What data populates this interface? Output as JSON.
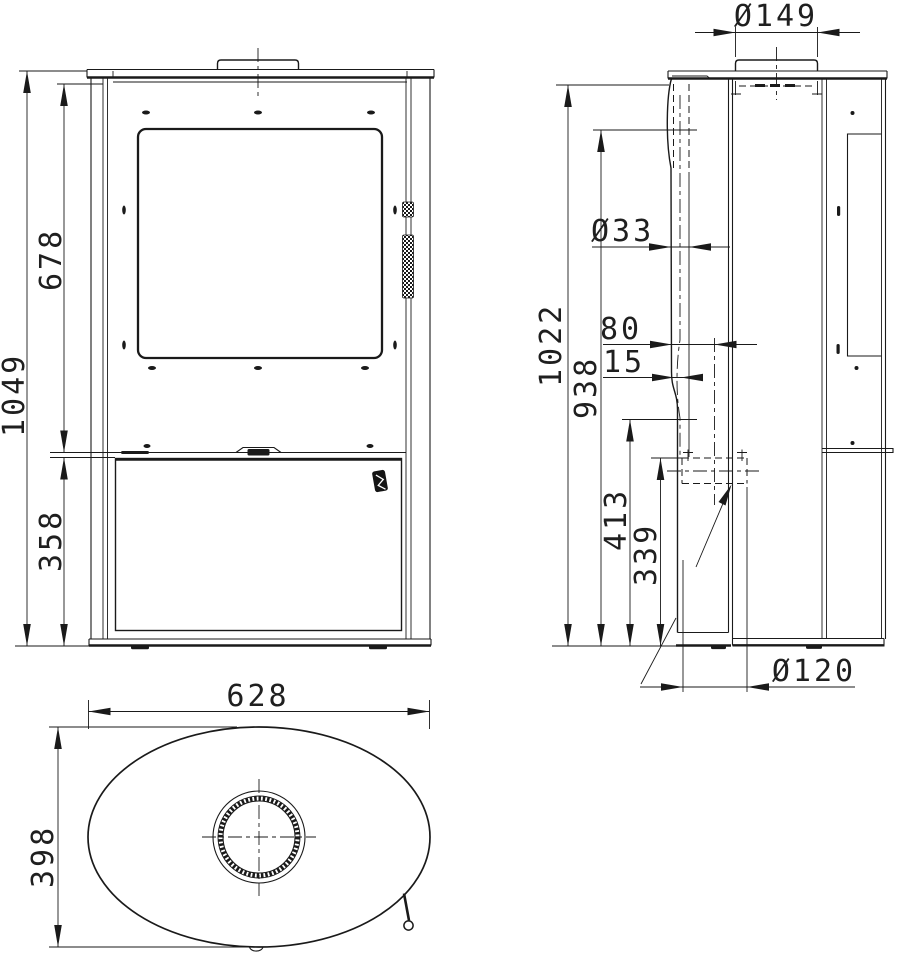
{
  "document": {
    "type": "technical-drawing",
    "subject": "oval free-standing stove, three orthographic views with dimensions"
  },
  "views": {
    "front": {
      "name": "front-view",
      "dims": {
        "total_height": "1049",
        "upper_height": "678",
        "lower_height": "358"
      }
    },
    "side": {
      "name": "side-view",
      "dims": {
        "overall_height": "1022",
        "flue_pipe_height": "938",
        "inlet_top_height": "413",
        "inlet_center_height": "339",
        "flue_collar_diameter": "Ø149",
        "secondary_pipe_diameter": "Ø33",
        "pipe_front_offset": "80",
        "pipe_wall_offset": "15",
        "air_inlet_diameter": "Ø120"
      }
    },
    "top": {
      "name": "top-view",
      "dims": {
        "overall_width": "628",
        "overall_depth": "398"
      }
    }
  }
}
